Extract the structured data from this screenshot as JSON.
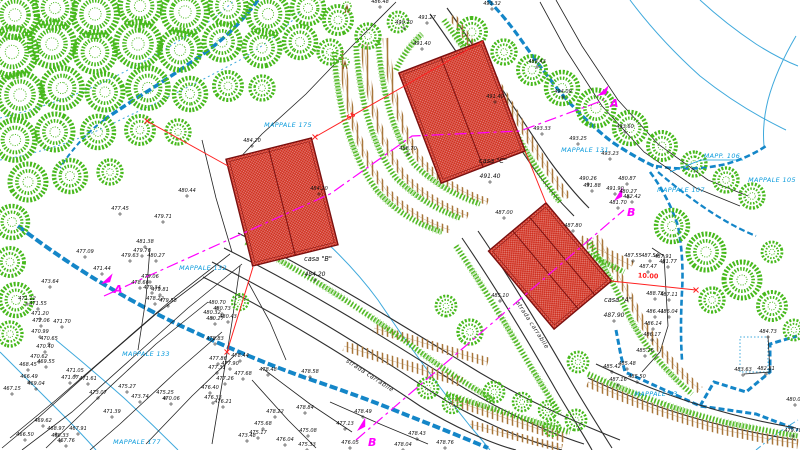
{
  "drawing": {
    "type": "cadastral site plan",
    "road_label_count": 2
  },
  "colors": {
    "tree_green": "#47b91c",
    "hedge_green": "#44b414",
    "building_red": "#d03020",
    "building_outline": "#7a1010",
    "road_gray": "#2f2f2f",
    "stream_blue": "#1486c8",
    "thin_stream_cyan": "#3fa9dc",
    "parcel_label_blue": "#0a9bdc",
    "section_magenta": "#ff00ff",
    "embankment_brown": "#a8763a",
    "dimension_red": "#ff2020",
    "spot_label_black": "#111111"
  },
  "parcels": [
    {
      "label": "MAPPALE 175",
      "x": 288,
      "y": 127
    },
    {
      "label": "MAPPALE 132",
      "x": 203,
      "y": 270
    },
    {
      "label": "MAPPALE 133",
      "x": 146,
      "y": 356
    },
    {
      "label": "MAPPALE 177",
      "x": 137,
      "y": 444
    },
    {
      "label": "MAPPALE 131",
      "x": 585,
      "y": 152
    },
    {
      "label": "MAPP. 106",
      "x": 722,
      "y": 158,
      "underline": true
    },
    {
      "label": "MAPPALE 105",
      "x": 772,
      "y": 182
    },
    {
      "label": "MAPPALE 107",
      "x": 681,
      "y": 192
    },
    {
      "label": "MAPPALE 73",
      "x": 656,
      "y": 396
    }
  ],
  "houses": [
    {
      "name": "casa \"B\"",
      "elevation": "484.20",
      "label_x": 318,
      "label_y": 261,
      "elev_x": 315,
      "elev_y": 276
    },
    {
      "name": "casa \"C\"",
      "elevation": "491.40",
      "label_x": 493,
      "label_y": 163,
      "elev_x": 490,
      "elev_y": 178
    },
    {
      "name": "casa \"A\"",
      "elevation": "487.90",
      "label_x": 618,
      "label_y": 302,
      "elev_x": 614,
      "elev_y": 317
    }
  ],
  "road_labels": [
    {
      "text": "strada carrabile",
      "x": 531,
      "y": 326,
      "rot": 57
    },
    {
      "text": "strada carrabile",
      "x": 369,
      "y": 377,
      "rot": 33
    }
  ],
  "sections": [
    {
      "letter": "A",
      "x": 114,
      "y": 293,
      "ax": 101,
      "ay": 284,
      "angle": -24
    },
    {
      "letter": "A",
      "x": 610,
      "y": 107,
      "ax": 597,
      "ay": 96,
      "angle": -24
    },
    {
      "letter": "B",
      "x": 368,
      "y": 446,
      "ax": 357,
      "ay": 431,
      "angle": -40
    },
    {
      "letter": "B",
      "x": 627,
      "y": 216,
      "ax": 614,
      "ay": 201,
      "angle": -40
    }
  ],
  "dimensions": [
    {
      "text": "10.00",
      "x": 648,
      "y": 278,
      "rot": 3
    },
    {
      "text": "55",
      "x": 352,
      "y": 118,
      "rot": -30
    }
  ],
  "spot_elevations": [
    {
      "x": 380,
      "y": 3,
      "v": "486.48"
    },
    {
      "x": 404,
      "y": 24,
      "v": "490.70"
    },
    {
      "x": 427,
      "y": 19,
      "v": "491.27"
    },
    {
      "x": 492,
      "y": 5,
      "v": "493.32"
    },
    {
      "x": 422,
      "y": 45,
      "v": "491.40"
    },
    {
      "x": 495,
      "y": 98,
      "v": "491.40"
    },
    {
      "x": 537,
      "y": 63,
      "v": "488.43"
    },
    {
      "x": 563,
      "y": 93,
      "v": "494.09"
    },
    {
      "x": 625,
      "y": 128,
      "v": "493.60"
    },
    {
      "x": 542,
      "y": 130,
      "v": "493.33"
    },
    {
      "x": 578,
      "y": 140,
      "v": "493.25"
    },
    {
      "x": 610,
      "y": 155,
      "v": "493.23"
    },
    {
      "x": 408,
      "y": 150,
      "v": "488.70"
    },
    {
      "x": 252,
      "y": 142,
      "v": "484.20"
    },
    {
      "x": 319,
      "y": 190,
      "v": "484.20"
    },
    {
      "x": 187,
      "y": 192,
      "v": "480.44"
    },
    {
      "x": 120,
      "y": 210,
      "v": "477.45"
    },
    {
      "x": 163,
      "y": 218,
      "v": "479.71"
    },
    {
      "x": 588,
      "y": 180,
      "v": "490.26"
    },
    {
      "x": 627,
      "y": 180,
      "v": "480.87"
    },
    {
      "x": 592,
      "y": 187,
      "v": "491.88"
    },
    {
      "x": 615,
      "y": 190,
      "v": "491.90"
    },
    {
      "x": 628,
      "y": 193,
      "v": "480.27"
    },
    {
      "x": 632,
      "y": 198,
      "v": "482.42"
    },
    {
      "x": 618,
      "y": 204,
      "v": "481.70"
    },
    {
      "x": 633,
      "y": 257,
      "v": "487.55"
    },
    {
      "x": 650,
      "y": 257,
      "v": "487.54"
    },
    {
      "x": 663,
      "y": 258,
      "v": "487.91"
    },
    {
      "x": 668,
      "y": 263,
      "v": "481.77"
    },
    {
      "x": 648,
      "y": 268,
      "v": "487.47"
    },
    {
      "x": 655,
      "y": 295,
      "v": "488.76"
    },
    {
      "x": 669,
      "y": 296,
      "v": "487.11"
    },
    {
      "x": 655,
      "y": 313,
      "v": "486.41"
    },
    {
      "x": 669,
      "y": 313,
      "v": "486.04"
    },
    {
      "x": 653,
      "y": 325,
      "v": "486.14"
    },
    {
      "x": 652,
      "y": 336,
      "v": "486.17"
    },
    {
      "x": 645,
      "y": 352,
      "v": "485.76"
    },
    {
      "x": 627,
      "y": 365,
      "v": "485.48"
    },
    {
      "x": 612,
      "y": 368,
      "v": "485.42"
    },
    {
      "x": 637,
      "y": 378,
      "v": "485.50"
    },
    {
      "x": 618,
      "y": 381,
      "v": "487.16"
    },
    {
      "x": 504,
      "y": 214,
      "v": "487.00"
    },
    {
      "x": 573,
      "y": 227,
      "v": "487.80"
    },
    {
      "x": 500,
      "y": 297,
      "v": "485.10"
    },
    {
      "x": 768,
      "y": 333,
      "v": "484.73"
    },
    {
      "x": 743,
      "y": 371,
      "v": "483.63"
    },
    {
      "x": 766,
      "y": 370,
      "v": "482.81"
    },
    {
      "x": 795,
      "y": 401,
      "v": "480.04"
    },
    {
      "x": 793,
      "y": 432,
      "v": "479.78"
    },
    {
      "x": 85,
      "y": 253,
      "v": "477.09"
    },
    {
      "x": 102,
      "y": 270,
      "v": "471.44"
    },
    {
      "x": 50,
      "y": 283,
      "v": "473.64"
    },
    {
      "x": 27,
      "y": 300,
      "v": "471.12"
    },
    {
      "x": 38,
      "y": 305,
      "v": "471.55"
    },
    {
      "x": 40,
      "y": 315,
      "v": "471.20"
    },
    {
      "x": 41,
      "y": 322,
      "v": "472.06"
    },
    {
      "x": 62,
      "y": 323,
      "v": "471.70"
    },
    {
      "x": 40,
      "y": 333,
      "v": "470.99"
    },
    {
      "x": 49,
      "y": 340,
      "v": "470.65"
    },
    {
      "x": 45,
      "y": 348,
      "v": "470.40"
    },
    {
      "x": 39,
      "y": 358,
      "v": "470.62"
    },
    {
      "x": 46,
      "y": 363,
      "v": "469.55"
    },
    {
      "x": 28,
      "y": 366,
      "v": "468.45"
    },
    {
      "x": 29,
      "y": 378,
      "v": "466.49"
    },
    {
      "x": 36,
      "y": 385,
      "v": "469.04"
    },
    {
      "x": 12,
      "y": 390,
      "v": "467.15"
    },
    {
      "x": 75,
      "y": 372,
      "v": "471.05"
    },
    {
      "x": 70,
      "y": 379,
      "v": "471.07"
    },
    {
      "x": 88,
      "y": 380,
      "v": "471.61"
    },
    {
      "x": 127,
      "y": 388,
      "v": "475.27"
    },
    {
      "x": 98,
      "y": 394,
      "v": "473.07"
    },
    {
      "x": 140,
      "y": 398,
      "v": "473.74"
    },
    {
      "x": 165,
      "y": 394,
      "v": "475.25"
    },
    {
      "x": 171,
      "y": 400,
      "v": "470.06"
    },
    {
      "x": 112,
      "y": 413,
      "v": "471.39"
    },
    {
      "x": 43,
      "y": 422,
      "v": "469.62"
    },
    {
      "x": 56,
      "y": 430,
      "v": "468.97"
    },
    {
      "x": 78,
      "y": 430,
      "v": "467.91"
    },
    {
      "x": 25,
      "y": 436,
      "v": "466.50"
    },
    {
      "x": 60,
      "y": 437,
      "v": "468.33"
    },
    {
      "x": 66,
      "y": 442,
      "v": "467.76"
    },
    {
      "x": 130,
      "y": 257,
      "v": "479.63"
    },
    {
      "x": 142,
      "y": 252,
      "v": "479.76"
    },
    {
      "x": 156,
      "y": 257,
      "v": "480.27"
    },
    {
      "x": 145,
      "y": 243,
      "v": "481.38"
    },
    {
      "x": 150,
      "y": 278,
      "v": "479.06"
    },
    {
      "x": 140,
      "y": 284,
      "v": "478.66"
    },
    {
      "x": 152,
      "y": 289,
      "v": "479.34"
    },
    {
      "x": 160,
      "y": 291,
      "v": "479.81"
    },
    {
      "x": 155,
      "y": 300,
      "v": "478.22"
    },
    {
      "x": 168,
      "y": 302,
      "v": "479.58"
    },
    {
      "x": 217,
      "y": 304,
      "v": "480.70"
    },
    {
      "x": 222,
      "y": 310,
      "v": "480.73"
    },
    {
      "x": 212,
      "y": 314,
      "v": "480.32"
    },
    {
      "x": 228,
      "y": 318,
      "v": "480.43"
    },
    {
      "x": 215,
      "y": 320,
      "v": "480.27"
    },
    {
      "x": 215,
      "y": 340,
      "v": "478.83"
    },
    {
      "x": 218,
      "y": 360,
      "v": "477.86"
    },
    {
      "x": 240,
      "y": 357,
      "v": "478.44"
    },
    {
      "x": 230,
      "y": 365,
      "v": "477.90"
    },
    {
      "x": 217,
      "y": 369,
      "v": "477.31"
    },
    {
      "x": 243,
      "y": 375,
      "v": "477.68"
    },
    {
      "x": 225,
      "y": 380,
      "v": "477.26"
    },
    {
      "x": 210,
      "y": 389,
      "v": "476.40"
    },
    {
      "x": 213,
      "y": 399,
      "v": "476.33"
    },
    {
      "x": 223,
      "y": 403,
      "v": "476.21"
    },
    {
      "x": 268,
      "y": 371,
      "v": "478.48"
    },
    {
      "x": 310,
      "y": 373,
      "v": "478.58"
    },
    {
      "x": 275,
      "y": 413,
      "v": "478.22"
    },
    {
      "x": 263,
      "y": 425,
      "v": "475.68"
    },
    {
      "x": 258,
      "y": 434,
      "v": "475.17"
    },
    {
      "x": 247,
      "y": 437,
      "v": "473.48"
    },
    {
      "x": 285,
      "y": 441,
      "v": "476.04"
    },
    {
      "x": 307,
      "y": 446,
      "v": "475.33"
    },
    {
      "x": 305,
      "y": 409,
      "v": "478.84"
    },
    {
      "x": 363,
      "y": 413,
      "v": "478.49"
    },
    {
      "x": 345,
      "y": 425,
      "v": "477.13"
    },
    {
      "x": 308,
      "y": 432,
      "v": "475.08"
    },
    {
      "x": 350,
      "y": 444,
      "v": "476.05"
    },
    {
      "x": 417,
      "y": 435,
      "v": "478.43"
    },
    {
      "x": 445,
      "y": 444,
      "v": "478.76"
    },
    {
      "x": 403,
      "y": 446,
      "v": "478.04"
    }
  ]
}
